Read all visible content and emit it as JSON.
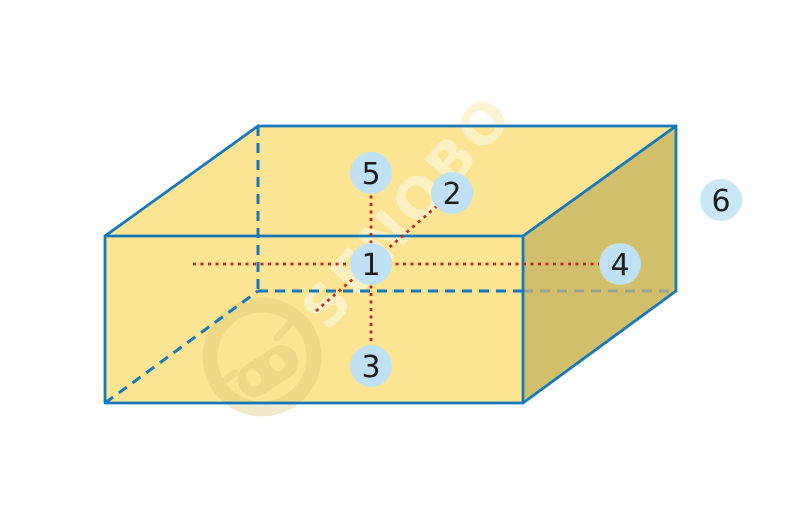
{
  "figure": {
    "type": "cuboid-direction-diagram",
    "watermark": {
      "text": "SENOBO"
    },
    "points": [
      {
        "id": "point-1",
        "label": "1",
        "position": "center of front face"
      },
      {
        "id": "point-2",
        "label": "2",
        "position": "upper-right along depth diagonal"
      },
      {
        "id": "point-3",
        "label": "3",
        "position": "below center"
      },
      {
        "id": "point-4",
        "label": "4",
        "position": "right, on horizontal axis"
      },
      {
        "id": "point-5",
        "label": "5",
        "position": "above center"
      },
      {
        "id": "point-6",
        "label": "6",
        "position": "outside box, right side"
      }
    ],
    "colors": {
      "box_fill": "#FBE592",
      "right_face_fill": "#D2BF6C",
      "edge_blue": "#1778BC",
      "hidden_edge_muted": "#94A394",
      "axis_red": "#C4271E",
      "marker_fill": "#BFE1F3",
      "marker_text": "#1C1C1C",
      "background": "#FFFFFF"
    }
  }
}
